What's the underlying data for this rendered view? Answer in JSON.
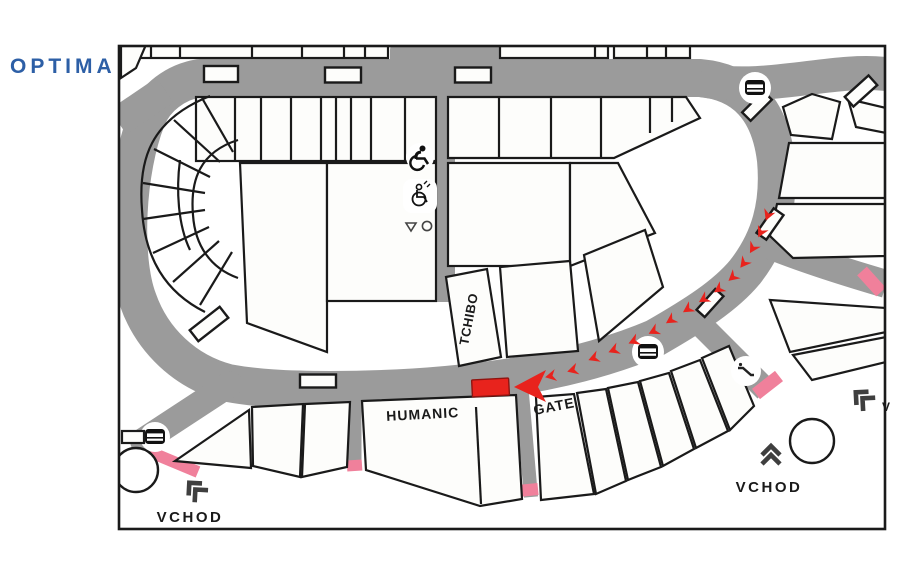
{
  "logo": {
    "text": "OPTIMA",
    "color": "#2d5fa6"
  },
  "map": {
    "labels": {
      "tchibo": "TCHIBO",
      "humanic": "HUMANIC",
      "gate": "GATE",
      "vchod_left": "VCHOD",
      "vchod_right": "VCHOD",
      "v_partial": "V"
    },
    "colors": {
      "corridor": "#9b9b9b",
      "outline": "#1a1a1a",
      "store_fill": "#fdfdfb",
      "entrance_pink": "#f0809b",
      "route_red": "#e8231d"
    },
    "icons": [
      "stairs-icon-top-right",
      "stairs-icon-center",
      "stairs-icon-bottom-left",
      "escalator-icon",
      "wheelchair-person-icon",
      "accessible-wc-icon",
      "triangle-marker",
      "circle-marker"
    ],
    "route": {
      "destination": "highlighted-store",
      "chevrons": [
        {
          "x": 768,
          "y": 215,
          "rot": -68
        },
        {
          "x": 761,
          "y": 232,
          "rot": -63
        },
        {
          "x": 753,
          "y": 248,
          "rot": -59
        },
        {
          "x": 744,
          "y": 263,
          "rot": -52
        },
        {
          "x": 733,
          "y": 277,
          "rot": -41
        },
        {
          "x": 719,
          "y": 289,
          "rot": -34
        },
        {
          "x": 704,
          "y": 299,
          "rot": -32
        },
        {
          "x": 688,
          "y": 309,
          "rot": -33
        },
        {
          "x": 671,
          "y": 320,
          "rot": -33
        },
        {
          "x": 654,
          "y": 331,
          "rot": -27
        },
        {
          "x": 634,
          "y": 341,
          "rot": -24
        },
        {
          "x": 614,
          "y": 350,
          "rot": -22
        },
        {
          "x": 594,
          "y": 358,
          "rot": -21
        },
        {
          "x": 573,
          "y": 370,
          "rot": -16
        },
        {
          "x": 551,
          "y": 376,
          "rot": -12
        }
      ]
    }
  }
}
